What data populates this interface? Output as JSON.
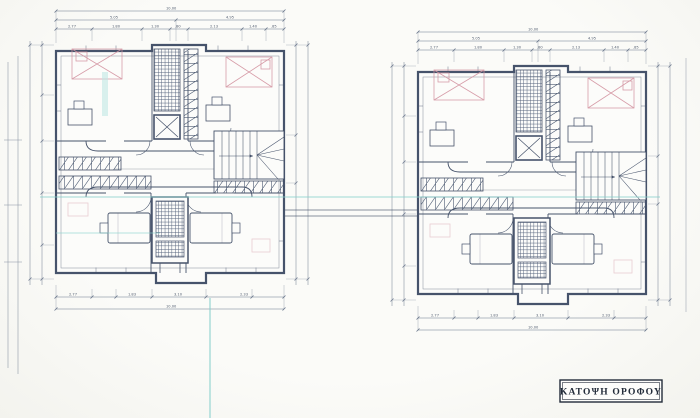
{
  "title_block": {
    "label": "ΚΑΤΟΨΗ ΟΡΟΦΟΥ"
  },
  "drawing": {
    "buildings": [
      {
        "name": "left house unit"
      },
      {
        "name": "right house unit"
      }
    ],
    "dims": {
      "overall_top": "10.00",
      "top_row2": [
        "5.05",
        "4.95"
      ],
      "top_row3": [
        "2.77",
        "1.80",
        "1.30",
        ".80",
        "2.13",
        "1.40",
        ".85"
      ],
      "bottom_row": [
        "2.77",
        "1.83",
        "3.10",
        "2.33"
      ],
      "overall_bottom": "10.00"
    },
    "colors": {
      "ink": "#46536b",
      "bed_pink": "#d393a0",
      "utility_cyan": "#86d0cb",
      "paper": "#f8f8f5"
    }
  }
}
